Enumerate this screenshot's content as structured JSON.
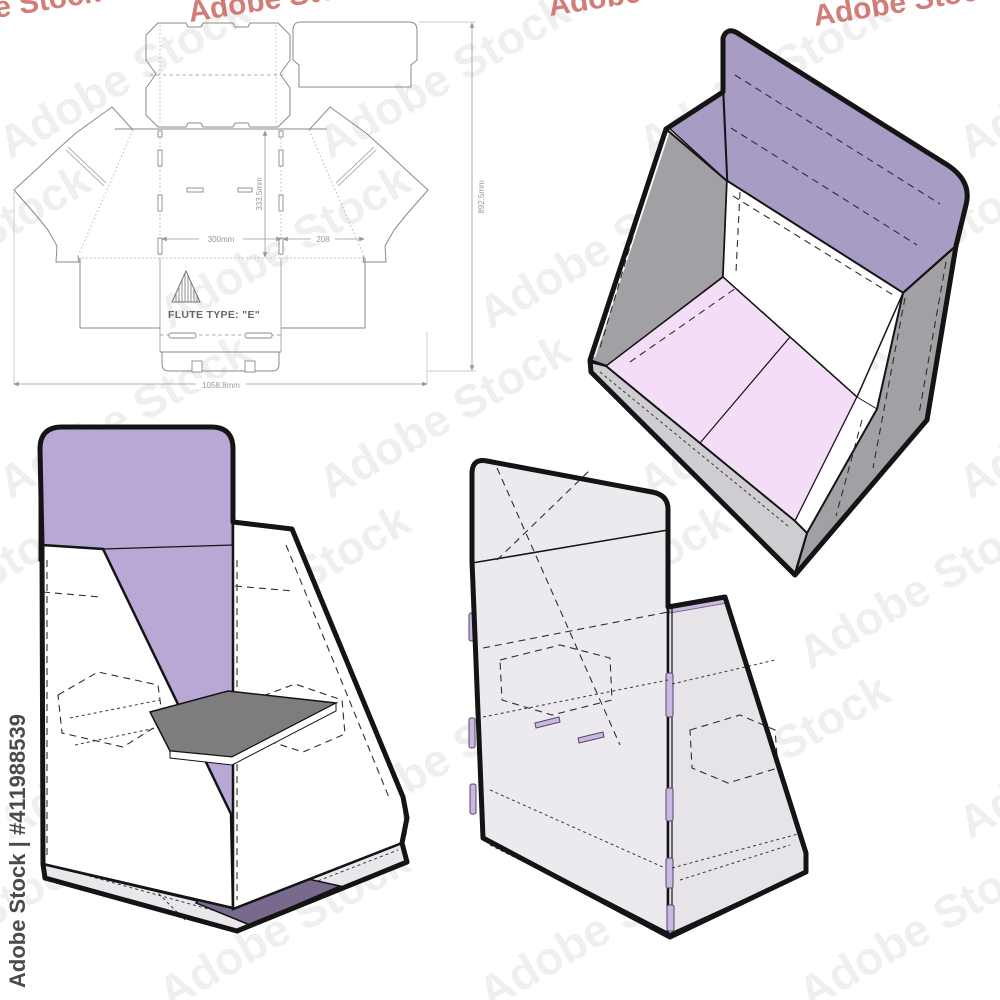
{
  "page": {
    "background_hex": "#ffffff"
  },
  "watermark": {
    "text": "Adobe Stock",
    "id_text": "Adobe Stock | #411988539",
    "tile_color_hex": "#8a8a8a",
    "top_row_color_hex": "#c4524a",
    "id_color_hex": "#3c3c3c"
  },
  "dieline": {
    "flute_label": "FLUTE TYPE: \"E\"",
    "line_color_hex": "#8a8a8a",
    "dimension_color_hex": "#999999",
    "dimensions": {
      "panel_width": "300mm",
      "side_width": "208",
      "panel_height": "333.5mm",
      "total_height": "892.5mm",
      "total_width": "1058.8mm"
    }
  },
  "assembled_views": {
    "front_top": {
      "header_hex": "#a89bc4",
      "side_hex": "#a3a0a5",
      "floor_hex": "#f4def7",
      "outline_hex": "#141414"
    },
    "front": {
      "header_hex": "#b9a7d6",
      "back_hex": "#b9a7d6",
      "shelf_hex": "#7f7c80",
      "floor_hex": "#776a8c",
      "base_hex": "#e9e7ec"
    },
    "back": {
      "panel_hex": "#eceaee",
      "side_hex": "#e6e3e9",
      "slot_hex": "#c9b8e0"
    }
  }
}
